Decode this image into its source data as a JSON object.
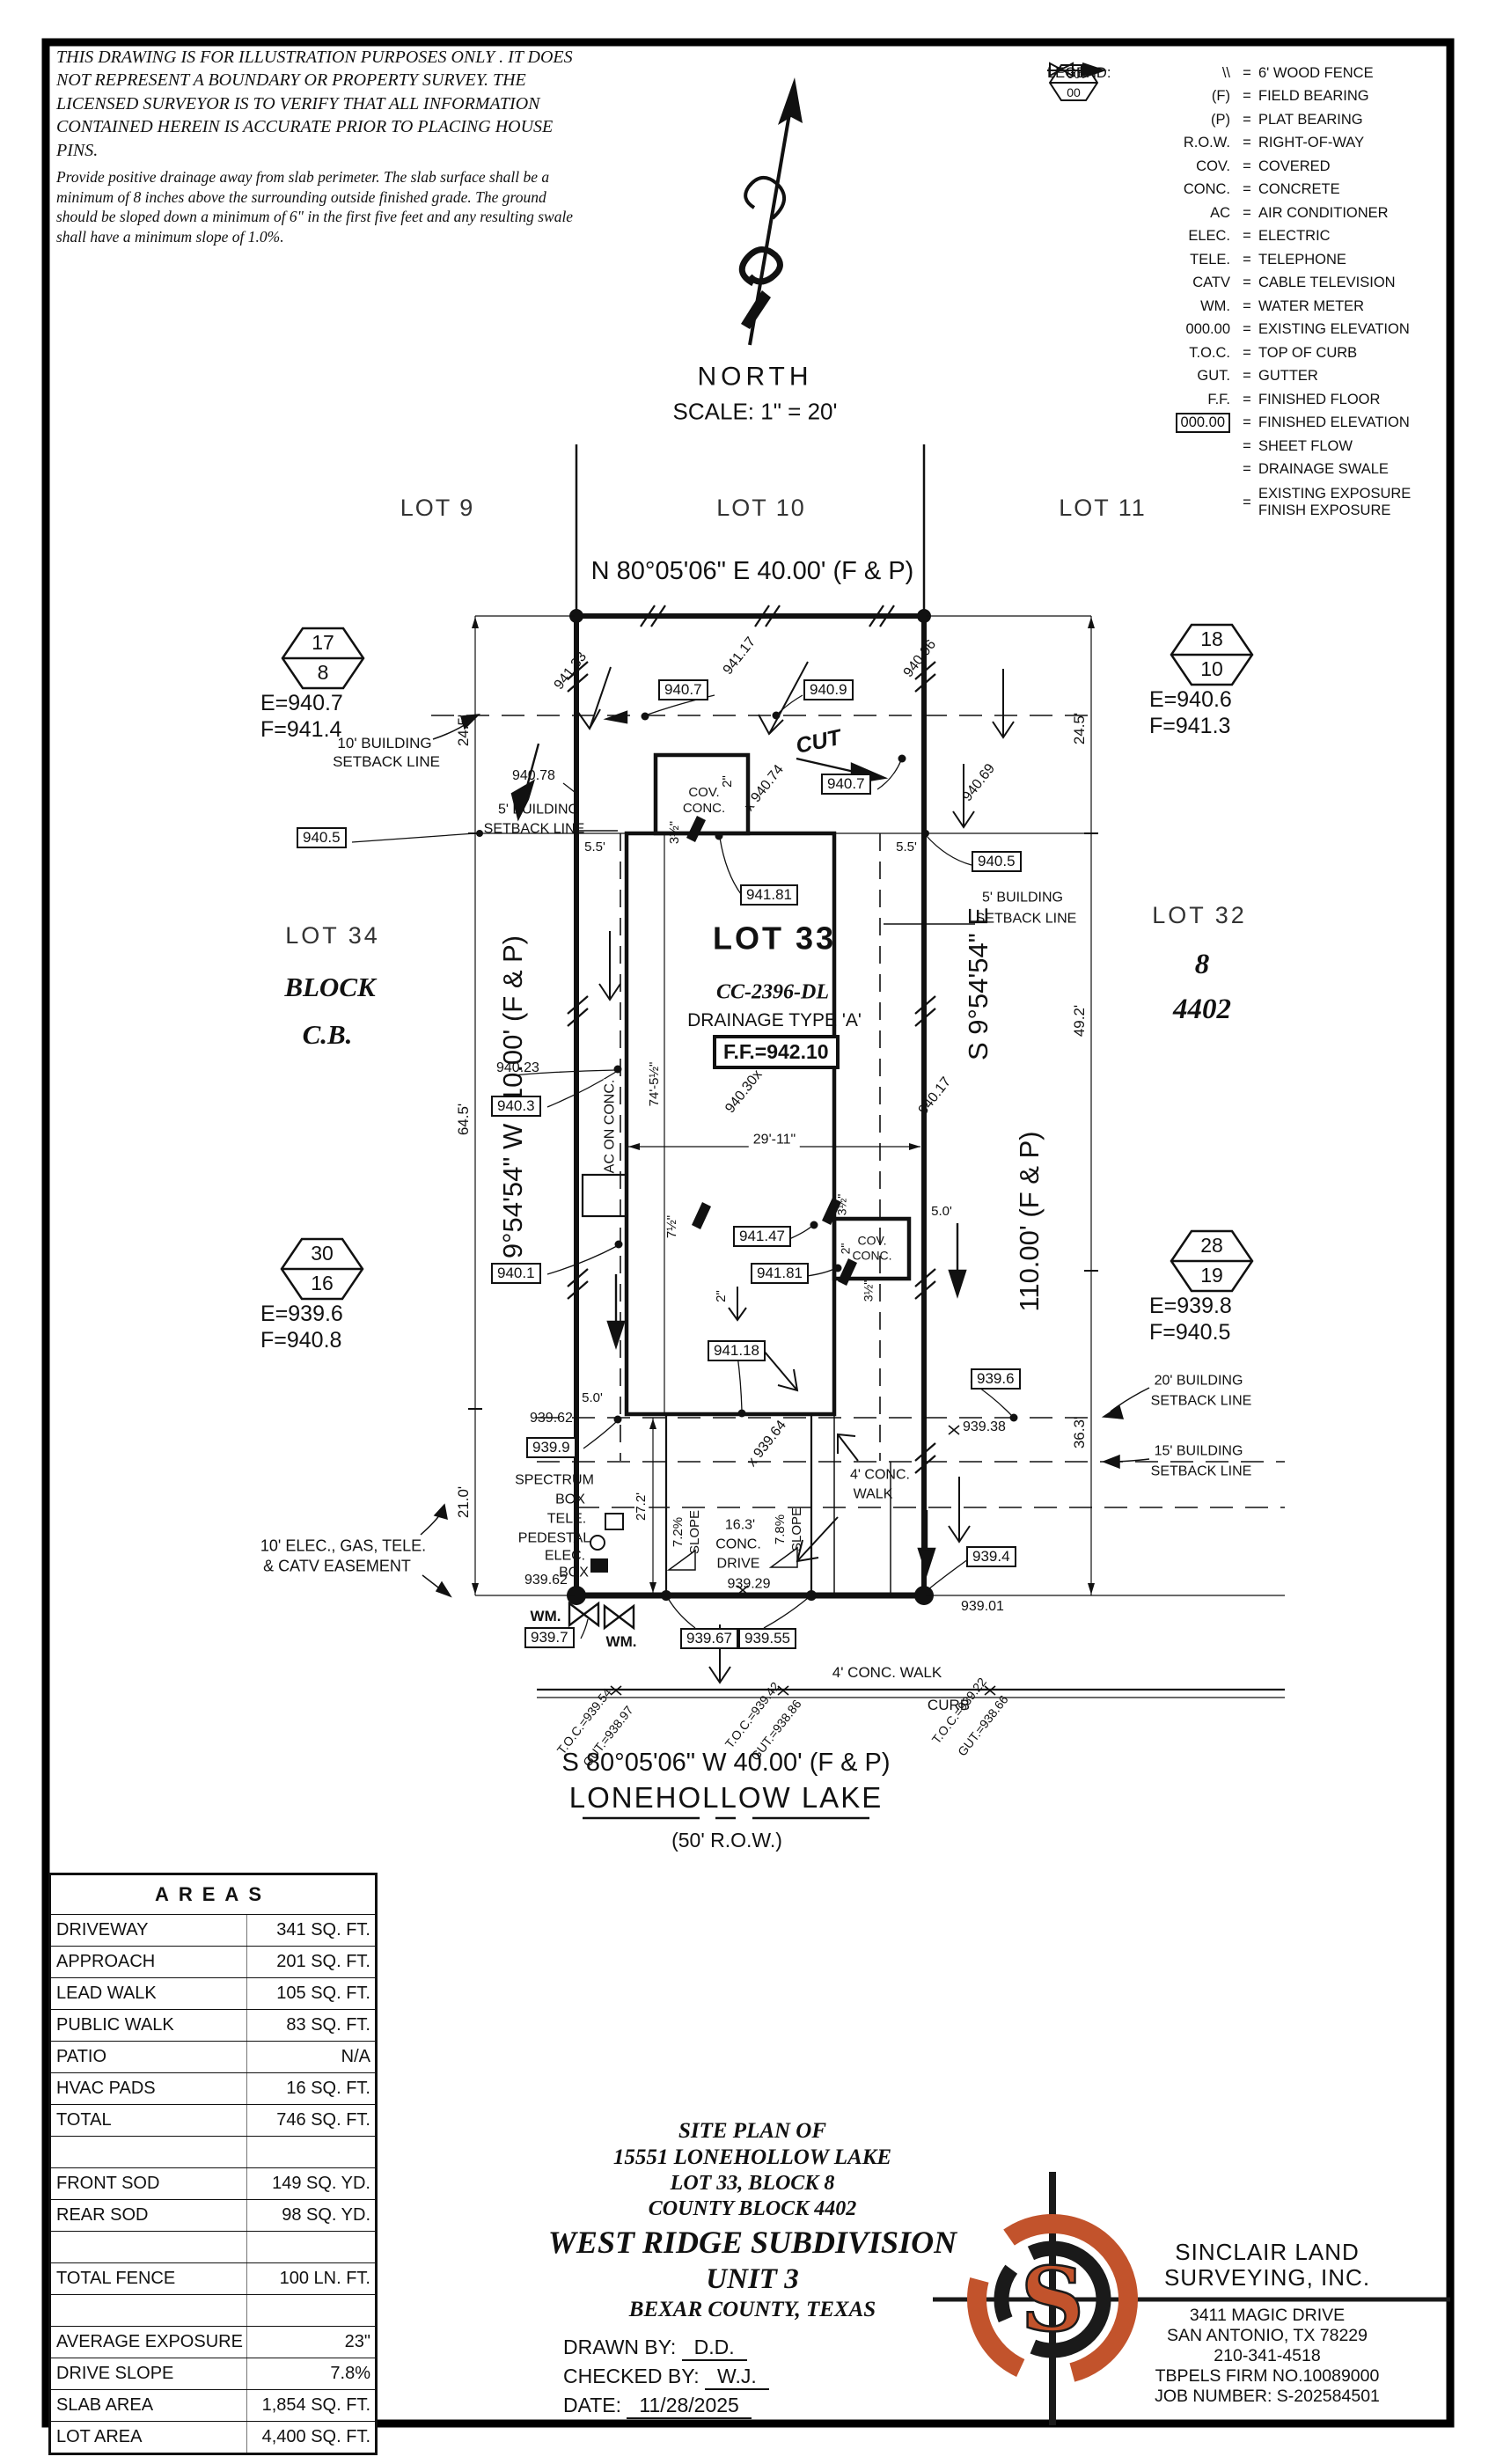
{
  "disclaimer": {
    "para1": "THIS DRAWING IS FOR ILLUSTRATION PURPOSES ONLY . IT DOES NOT REPRESENT A BOUNDARY OR PROPERTY SURVEY. THE LICENSED SURVEYOR IS TO VERIFY THAT ALL INFORMATION CONTAINED HEREIN IS ACCURATE PRIOR TO PLACING HOUSE PINS.",
    "para2": "Provide positive drainage away from slab perimeter. The slab surface shall be a minimum of 8 inches above the surrounding outside finished grade. The ground should be sloped down a minimum of 6\" in the first five feet and any resulting swale shall have a minimum slope of 1.0%."
  },
  "compass": {
    "north": "NORTH",
    "scale": "SCALE: 1\" = 20'"
  },
  "legend": {
    "title": "LEGEND:",
    "eq": "=",
    "hex_top": "00",
    "hex_bot": "00",
    "items": [
      {
        "sym": "\\\\",
        "desc": "6' WOOD FENCE"
      },
      {
        "sym": "(F)",
        "desc": "FIELD BEARING"
      },
      {
        "sym": "(P)",
        "desc": "PLAT BEARING"
      },
      {
        "sym": "R.O.W.",
        "desc": "RIGHT-OF-WAY"
      },
      {
        "sym": "COV.",
        "desc": "COVERED"
      },
      {
        "sym": "CONC.",
        "desc": "CONCRETE"
      },
      {
        "sym": "AC",
        "desc": "AIR CONDITIONER"
      },
      {
        "sym": "ELEC.",
        "desc": "ELECTRIC"
      },
      {
        "sym": "TELE.",
        "desc": "TELEPHONE"
      },
      {
        "sym": "CATV",
        "desc": "CABLE TELEVISION"
      },
      {
        "sym": "WM.",
        "desc": "WATER METER"
      },
      {
        "sym": "000.00",
        "desc": "EXISTING ELEVATION"
      },
      {
        "sym": "T.O.C.",
        "desc": "TOP OF CURB"
      },
      {
        "sym": "GUT.",
        "desc": "GUTTER"
      },
      {
        "sym": "F.F.",
        "desc": "FINISHED FLOOR"
      },
      {
        "sym": "000.00",
        "desc": "FINISHED ELEVATION"
      },
      {
        "sym": "",
        "desc": "SHEET FLOW"
      },
      {
        "sym": "",
        "desc": "DRAINAGE SWALE"
      },
      {
        "sym": "",
        "desc": "EXISTING EXPOSURE",
        "desc2": "FINISH EXPOSURE"
      }
    ]
  },
  "plat": {
    "labels": {
      "lot9": "LOT 9",
      "lot10": "LOT 10",
      "lot11": "LOT 11",
      "bearing_top": "N 80°05'06\" E  40.00'  (F & P)",
      "bearing_left": "N 9°54'54\" W  110.00'  (F & P)",
      "bearing_right1": "S 9°54'54\" E",
      "bearing_right2": "110.00'  (F & P)",
      "bearing_bottom": "S 80°05'06\" W  40.00'  (F & P)",
      "street": "LONEHOLLOW LAKE",
      "row": "(50' R.O.W.)",
      "lot33": "LOT 33",
      "cc": "CC-2396-DL",
      "drainage": "DRAINAGE  TYPE  'A'",
      "ff": "F.F.=942.10",
      "lot34": "LOT 34",
      "block1": "BLOCK",
      "block2": "C.B.",
      "lot32": "LOT 32",
      "block8": "8",
      "cb4402": "4402",
      "hex1_top": "17",
      "hex1_bot": "8",
      "hex1_e": "E=940.7",
      "hex1_f": "F=941.4",
      "hex2_top": "18",
      "hex2_bot": "10",
      "hex2_e": "E=940.6",
      "hex2_f": "F=941.3",
      "hex3_top": "30",
      "hex3_bot": "16",
      "hex3_e": "E=939.6",
      "hex3_f": "F=940.8",
      "hex4_top": "28",
      "hex4_bot": "19",
      "hex4_e": "E=939.8",
      "hex4_f": "F=940.5",
      "sb10a": "10' BUILDING",
      "sb10b": "SETBACK LINE",
      "sb5la": "5' BUILDING",
      "sb5lb": "SETBACK LINE",
      "sb5ra": "5' BUILDING",
      "sb5rb": "SETBACK LINE",
      "sb20a": "20' BUILDING",
      "sb20b": "SETBACK LINE",
      "sb15a": "15' BUILDING",
      "sb15b": "SETBACK LINE",
      "easement1": "10' ELEC., GAS, TELE.",
      "easement2": "& CATV EASEMENT",
      "dim245l": "24.5'",
      "dim245r": "24.5'",
      "dim645": "64.5'",
      "dim492": "49.2'",
      "dim210": "21.0'",
      "dim363": "36.3'",
      "dim272": "27.2'",
      "dim745": "74'-5½\"",
      "dim2911": "29'-11\"",
      "dim55l": "5.5'",
      "dim55r": "5.5'",
      "dim50l": "5.0'",
      "dim50r": "5.0'",
      "e94133": "941.33",
      "e94117": "941.17",
      "e94096": "940.96",
      "e94078": "940.78",
      "e94069": "940.69",
      "e94023": "940.23",
      "e94017": "940.17",
      "x94074": "x 940.74",
      "x94030": "940.30x",
      "x93964": "x 939.64",
      "cut": "CUT",
      "b9407a": "940.7",
      "b9409": "940.9",
      "b9407b": "940.7",
      "b94181a": "941.81",
      "b9405l": "940.5",
      "b9405r": "940.5",
      "b9403": "940.3",
      "b9401": "940.1",
      "b94147": "941.47",
      "b94181b": "941.81",
      "b94118": "941.18",
      "b9396": "939.6",
      "b9394": "939.4",
      "b9399": "939.9",
      "b9397": "939.7",
      "b93967": "939.67",
      "b93955": "939.55",
      "e93962a": "939.62",
      "e93962b": "939.62",
      "e93938": "939.38",
      "e93901": "939.01",
      "e93929": "939.29",
      "covconc1a": "COV.",
      "covconc1b": "CONC.",
      "covconc2a": "COV.",
      "covconc2b": "CONC.",
      "aconc": "AC ON CONC.",
      "in2a": "2\"",
      "in2b": "2\"",
      "in2c": "2\"",
      "in35a": "3½\"",
      "in35b": "3½\"",
      "in35c": "3½\"",
      "in75": "7½\"",
      "spectrum1": "SPECTRUM",
      "spectrum2": "BOX",
      "tele1": "TELE.",
      "tele2": "PEDESTAL",
      "elec1": "ELEC.",
      "elec2": "BOX",
      "wm1": "WM.",
      "wm2": "WM.",
      "slope72": "7.2%",
      "slope78": "7.8%",
      "slopea": "SLOPE",
      "slopeb": "SLOPE",
      "drive1": "16.3'",
      "drive2": "CONC.",
      "drive3": "DRIVE",
      "walkup1": "4' CONC.",
      "walkup2": "WALK",
      "walkdn": "4' CONC. WALK",
      "curb": "CURB",
      "toc1a": "T.O.C.=939.54",
      "toc1b": "GUT.=938.97",
      "toc2a": "T.O.C.=939.42",
      "toc2b": "GUT.=938.86",
      "toc3a": "T.O.C.=939.22",
      "toc3b": "GUT.=938.66"
    }
  },
  "areas": {
    "title": "AREAS",
    "rows": [
      {
        "label": "DRIVEWAY",
        "value": "341 SQ. FT."
      },
      {
        "label": "APPROACH",
        "value": "201 SQ. FT."
      },
      {
        "label": "LEAD WALK",
        "value": "105 SQ. FT."
      },
      {
        "label": "PUBLIC WALK",
        "value": "83 SQ. FT."
      },
      {
        "label": "PATIO",
        "value": "N/A"
      },
      {
        "label": "HVAC PADS",
        "value": "16 SQ. FT."
      },
      {
        "label": "TOTAL",
        "value": "746 SQ. FT."
      },
      {
        "label": "",
        "value": ""
      },
      {
        "label": "FRONT SOD",
        "value": "149 SQ. YD."
      },
      {
        "label": "REAR SOD",
        "value": "98 SQ. YD."
      },
      {
        "label": "",
        "value": ""
      },
      {
        "label": "TOTAL FENCE",
        "value": "100 LN. FT."
      },
      {
        "label": "",
        "value": ""
      },
      {
        "label": "AVERAGE EXPOSURE",
        "value": "23\""
      },
      {
        "label": "DRIVE SLOPE",
        "value": "7.8%"
      },
      {
        "label": "SLAB AREA",
        "value": "1,854 SQ. FT."
      },
      {
        "label": "LOT AREA",
        "value": "4,400 SQ. FT."
      }
    ]
  },
  "title_block": {
    "line1": "SITE PLAN OF",
    "line2": "15551 LONEHOLLOW LAKE",
    "line3": "LOT 33, BLOCK 8",
    "line4": "COUNTY BLOCK 4402",
    "line5": "WEST RIDGE SUBDIVISION",
    "line6": "UNIT 3",
    "line7": "BEXAR COUNTY, TEXAS",
    "drawn_label": "DRAWN BY:",
    "drawn_value": "D.D.",
    "checked_label": "CHECKED BY:",
    "checked_value": "W.J.",
    "date_label": "DATE:",
    "date_value": "11/28/2025"
  },
  "firm": {
    "accent": "#c2532c",
    "logo_letter": "S",
    "name1": "SINCLAIR LAND",
    "name2": "SURVEYING, INC.",
    "address1": "3411 MAGIC DRIVE",
    "address2": "SAN ANTONIO, TX 78229",
    "phone": "210-341-4518",
    "firm_no": "TBPELS FIRM NO.10089000",
    "job": "JOB NUMBER: S-202584501"
  }
}
